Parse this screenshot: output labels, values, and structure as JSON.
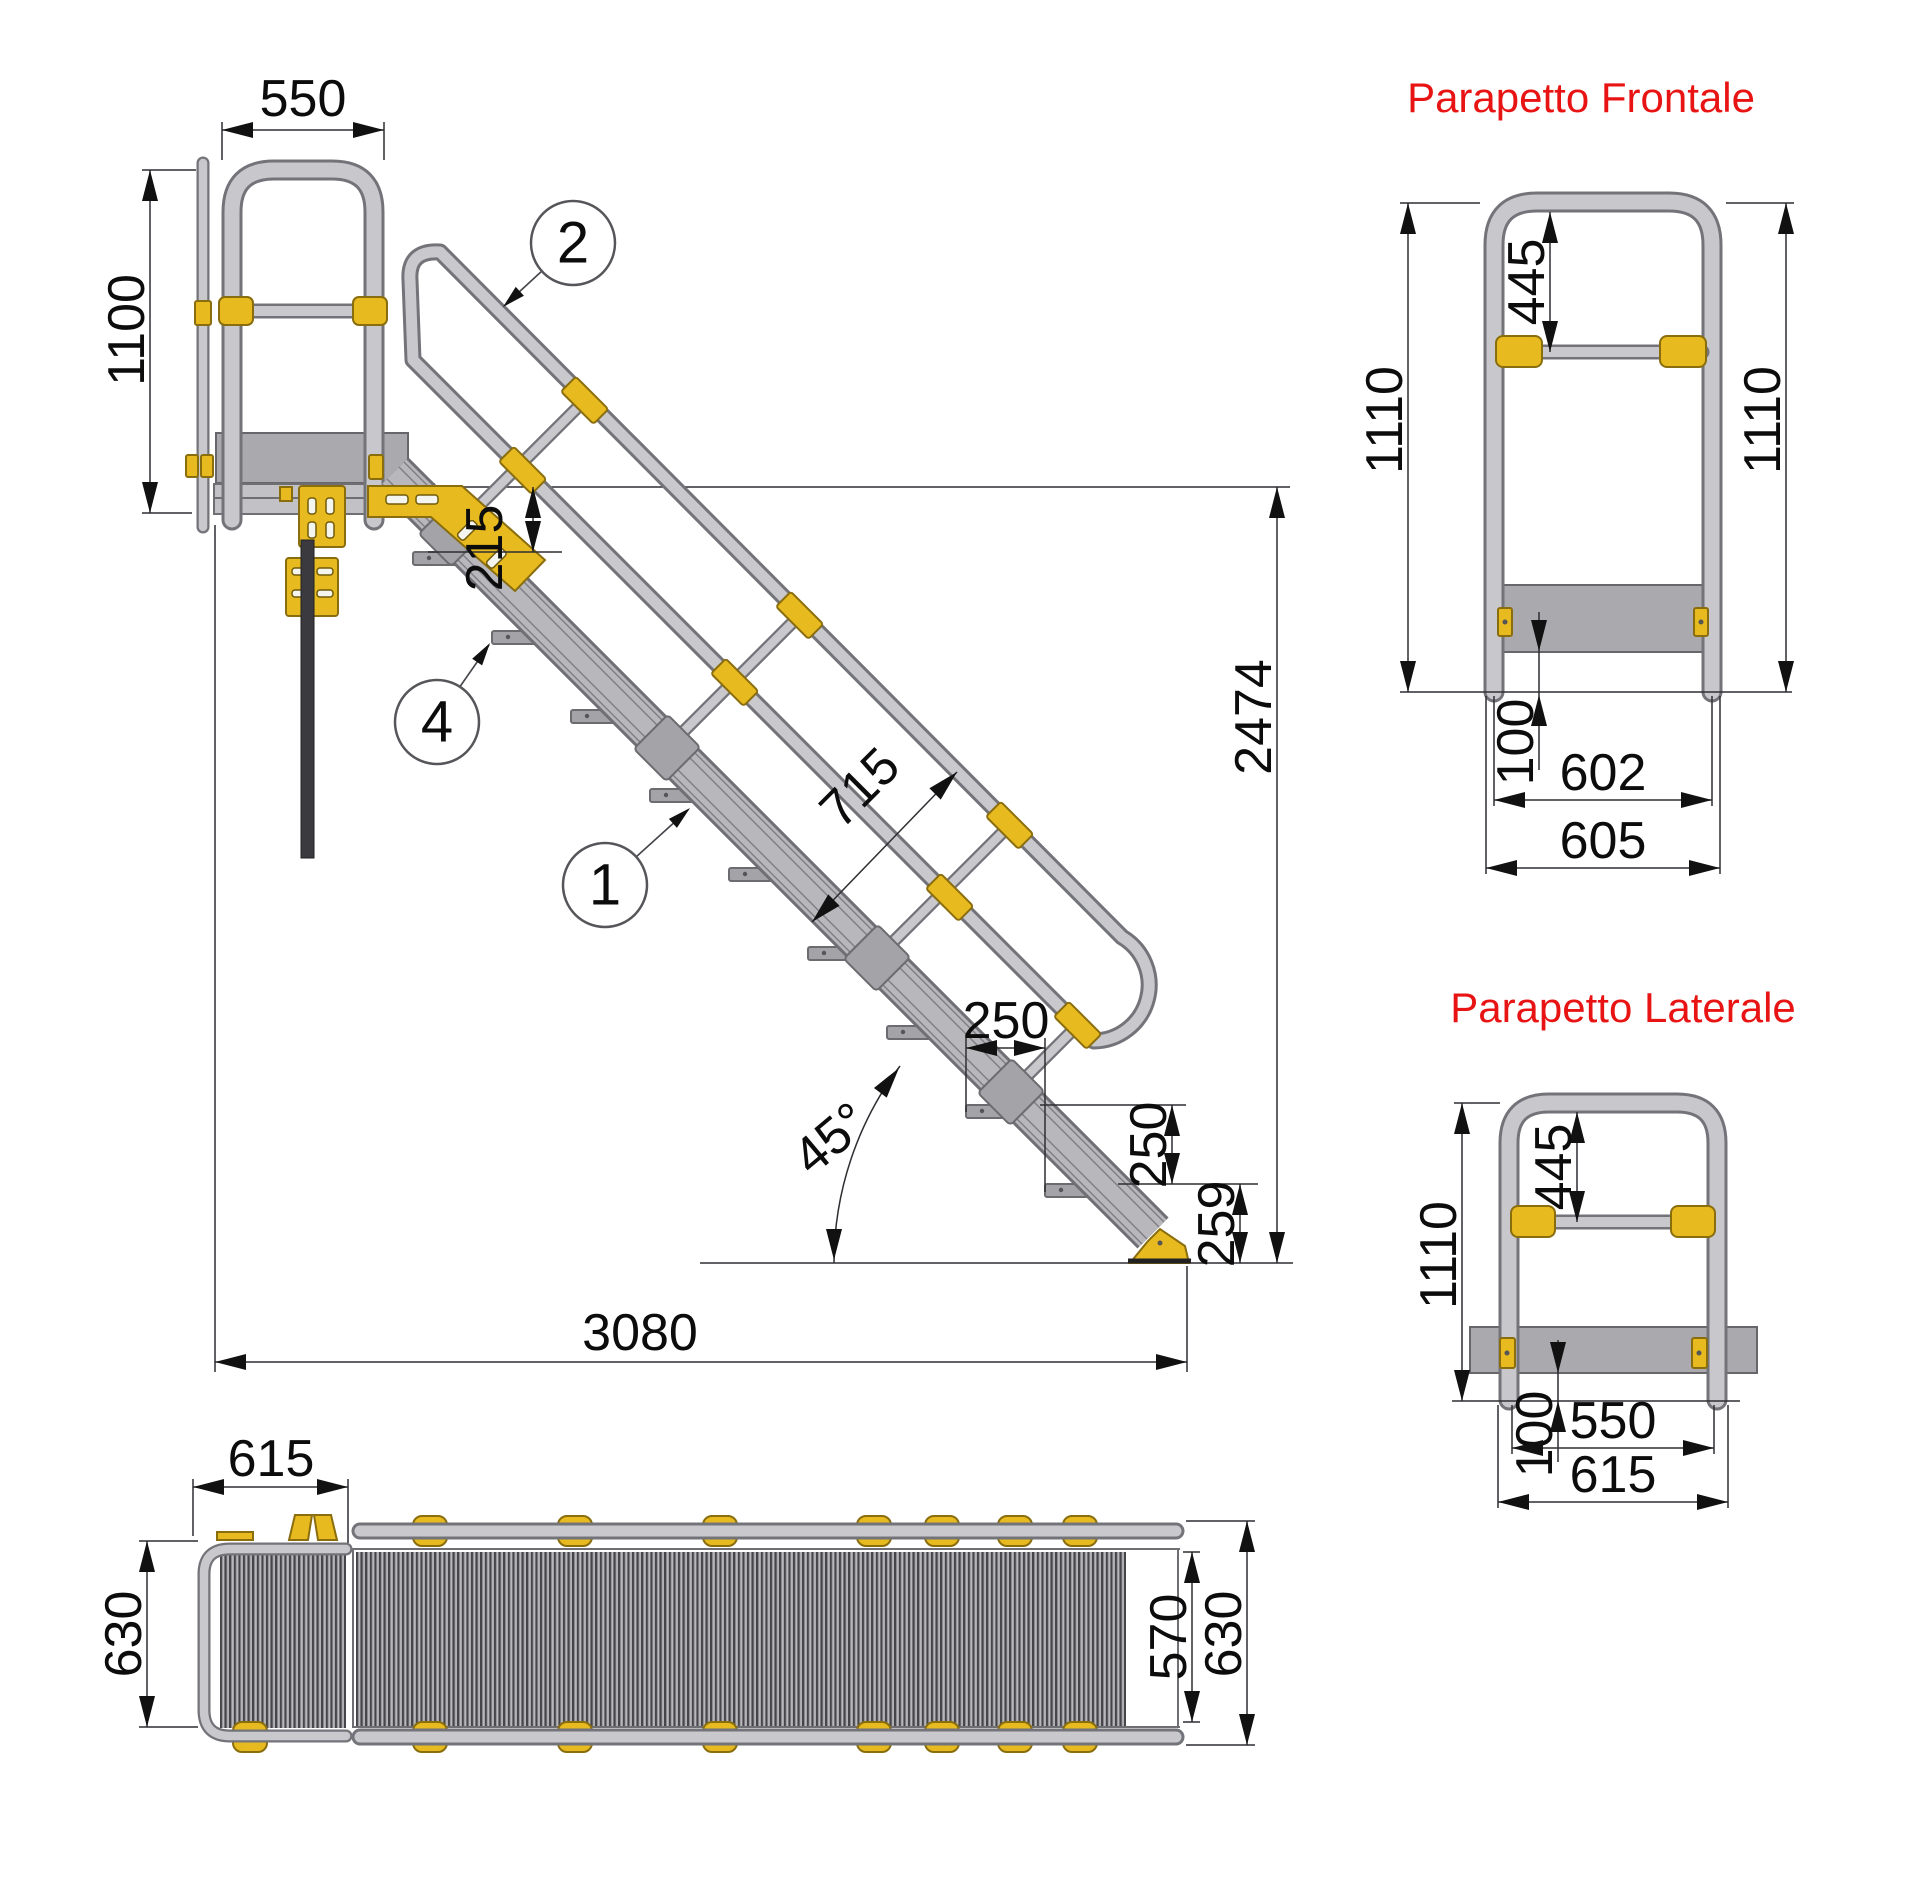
{
  "main_view": {
    "dims": {
      "platform_width": "550",
      "guardrail_height": "1100",
      "first_step_drop": "215",
      "handrail_offset": "715",
      "step_run": "250",
      "step_rise": "250",
      "foot_height": "259",
      "total_height": "2474",
      "total_length": "3080",
      "angle": "45°"
    },
    "balloons": [
      {
        "number": "2"
      },
      {
        "number": "4"
      },
      {
        "number": "1"
      }
    ]
  },
  "front_guardrail": {
    "title": "Parapetto Frontale",
    "dims": {
      "top_to_midrail": "445",
      "height_left": "1110",
      "height_right": "1110",
      "toeboard_height": "100",
      "width_inner": "602",
      "width_outer": "605"
    }
  },
  "side_guardrail": {
    "title": "Parapetto Laterale",
    "dims": {
      "top_to_midrail": "445",
      "height": "1110",
      "toeboard_height": "100",
      "width_inner": "550",
      "width_outer": "615"
    }
  },
  "plan_view": {
    "dims": {
      "platform_width": "615",
      "platform_depth": "630",
      "walkway_width": "570",
      "overall_width": "630"
    }
  },
  "colors": {
    "title_red": "#e81414",
    "connector_yellow": "#e7ba20",
    "tube_gray": "#c7c7cc",
    "plate_gray": "#a9a9ae"
  }
}
